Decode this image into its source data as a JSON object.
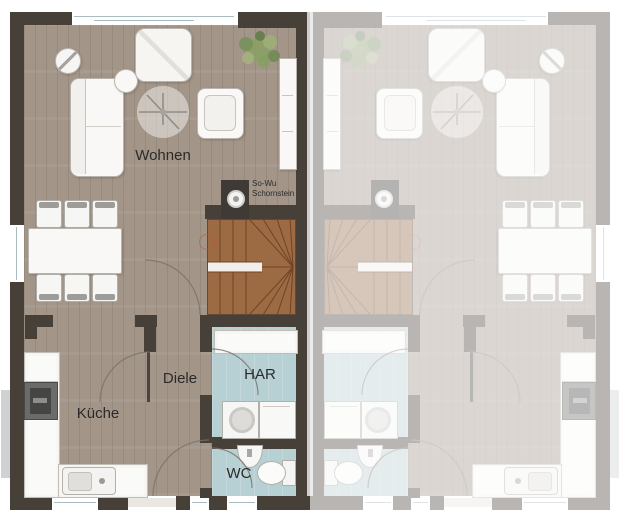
{
  "plan": {
    "type": "floor-plan",
    "units": [
      "left-unit-active",
      "right-unit-mirrored-faded"
    ]
  },
  "labels": {
    "living": "Wohnen",
    "kitchen": "Küche",
    "hall": "Diele",
    "utility": "HAR",
    "wc": "WC",
    "chimney_line1": "So-Wu",
    "chimney_line2": "Schornstein"
  },
  "furniture": {
    "living": [
      "sofa",
      "armchair",
      "ottoman",
      "side-table",
      "ceiling-fan",
      "plant",
      "sideboard",
      "dining-table"
    ],
    "dining_chairs": 6,
    "kitchen": [
      "counter",
      "stove",
      "sink"
    ],
    "utility": [
      "worktop",
      "washing-machine",
      "dryer"
    ],
    "wc": [
      "hand-basin",
      "toilet"
    ],
    "circulation": [
      "winder-staircase",
      "chimney",
      "door-arcs"
    ]
  },
  "colors": {
    "background": "#ffffff",
    "wall": "#474039",
    "wood_floor": "#a39689",
    "wet_room_floor": "#b7d0d4",
    "stair_wood": "#9c6b44",
    "glazing": "#a8bcc2",
    "door_arc": "#7a7168",
    "faded_unit_opacity": "0.38"
  }
}
